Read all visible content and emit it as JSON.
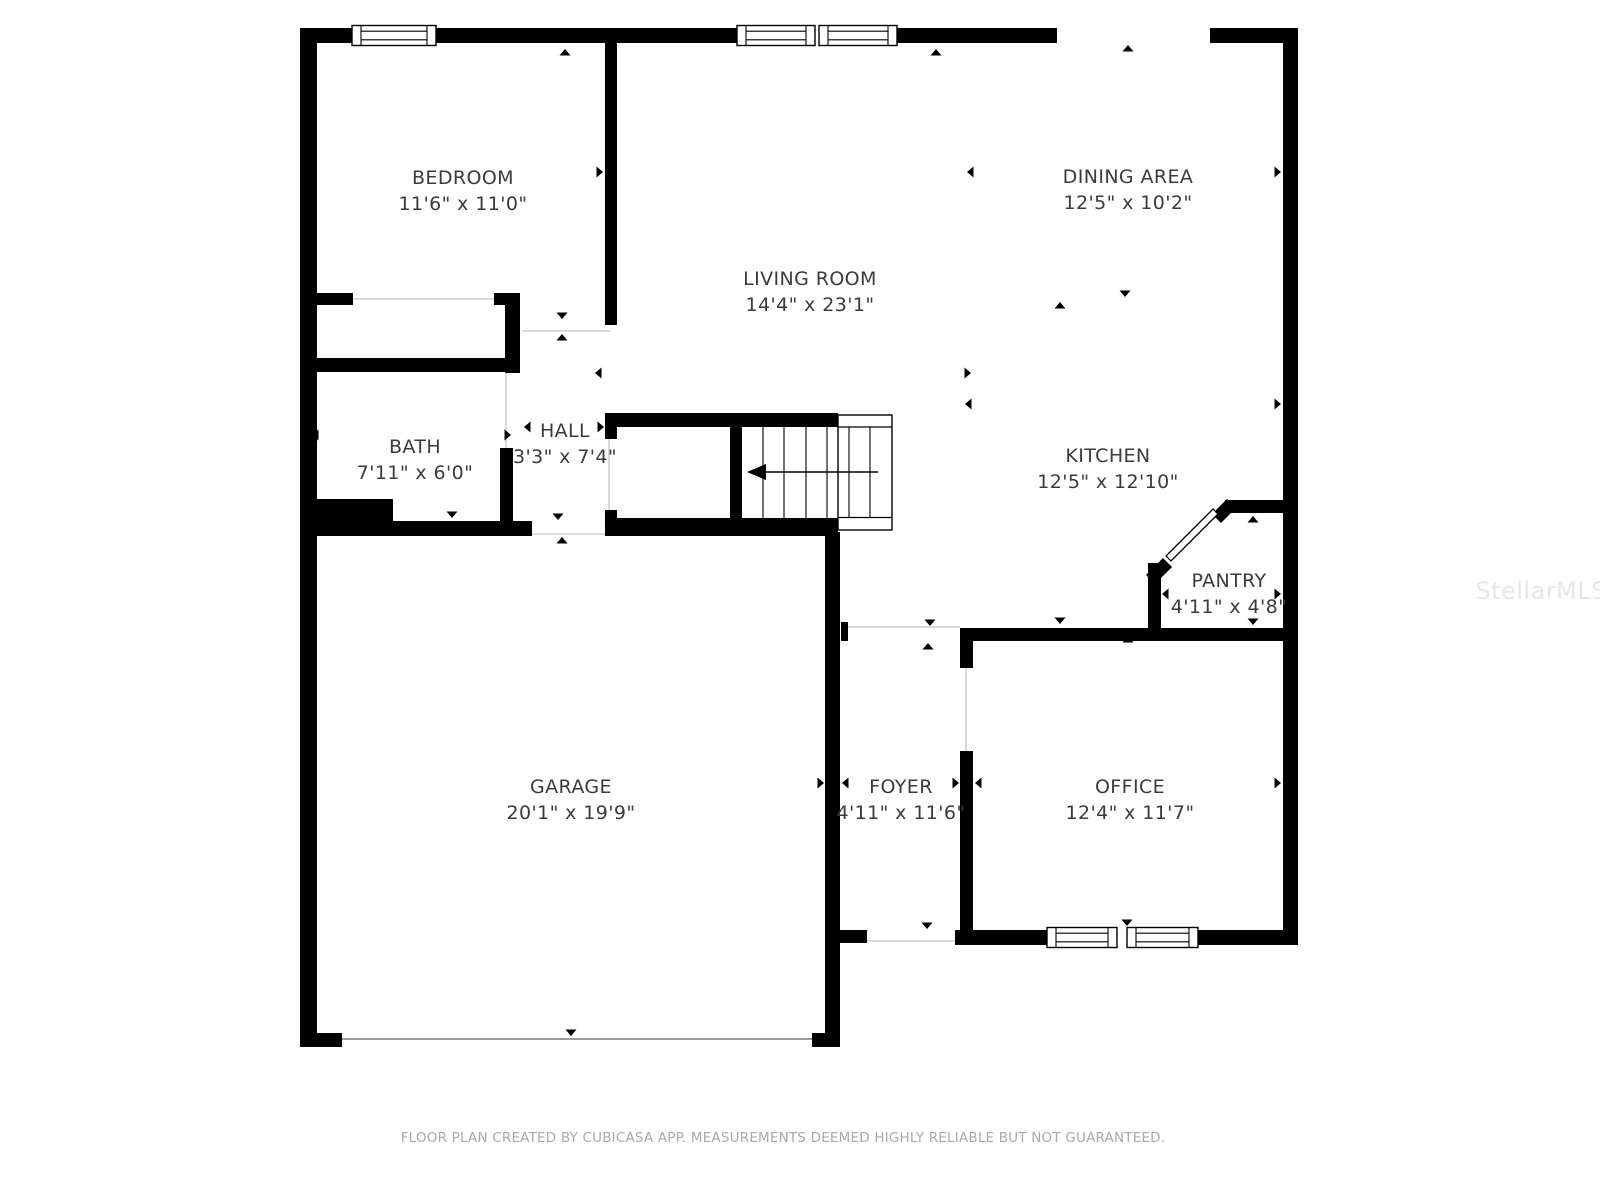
{
  "floor_plan": {
    "rooms": {
      "bedroom": {
        "name": "BEDROOM",
        "dimensions": "11'6\" x 11'0\""
      },
      "living_room": {
        "name": "LIVING ROOM",
        "dimensions": "14'4\" x 23'1\""
      },
      "dining_area": {
        "name": "DINING AREA",
        "dimensions": "12'5\" x 10'2\""
      },
      "bath": {
        "name": "BATH",
        "dimensions": "7'11\" x 6'0\""
      },
      "hall": {
        "name": "HALL",
        "dimensions": "3'3\" x 7'4\""
      },
      "kitchen": {
        "name": "KITCHEN",
        "dimensions": "12'5\" x 12'10\""
      },
      "pantry": {
        "name": "PANTRY",
        "dimensions": "4'11\" x 4'8\""
      },
      "garage": {
        "name": "GARAGE",
        "dimensions": "20'1\" x 19'9\""
      },
      "foyer": {
        "name": "FOYER",
        "dimensions": "4'11\" x 11'6\""
      },
      "office": {
        "name": "OFFICE",
        "dimensions": "12'4\" x 11'7\""
      }
    },
    "footer_text": "FLOOR PLAN CREATED BY CUBICASA APP. MEASUREMENTS DEEMED HIGHLY RELIABLE BUT NOT GUARANTEED.",
    "watermark": "StellarMLS",
    "icons": {
      "stair_direction_arrow": "left-arrow",
      "measure_tick": "small-triangle"
    },
    "colors": {
      "wall": "#000000",
      "background": "#ffffff",
      "label": "#3b3b3b",
      "footer": "#a9a9a9",
      "watermark": "#e7e7e7",
      "threshold": "#cfcfcf",
      "garage-door": "#9a9a9a"
    }
  }
}
